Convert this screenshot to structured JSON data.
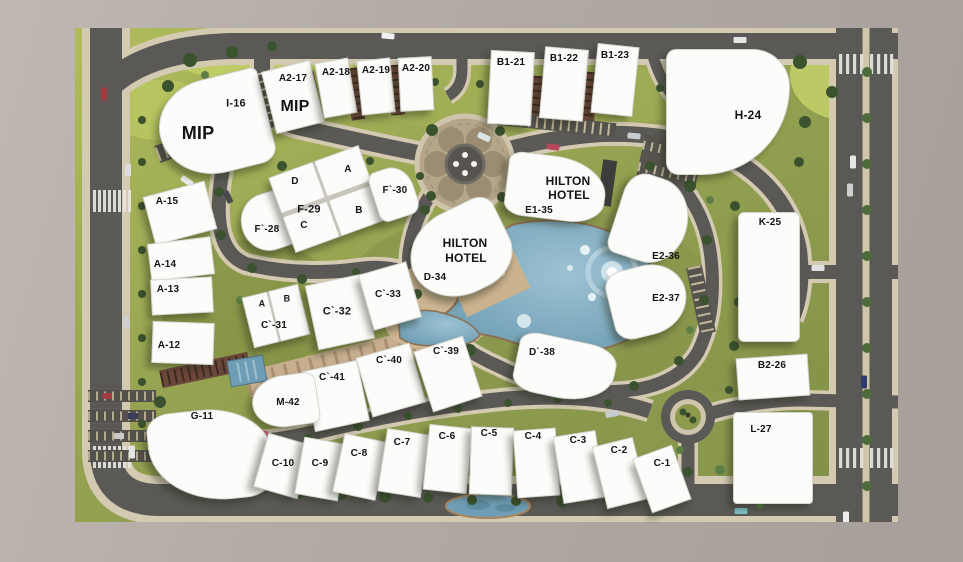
{
  "scene": {
    "name": "residential compound master plan",
    "hotel_name": "HILTON HOTEL",
    "mip_label": "MIP"
  },
  "colors": {
    "frame": "#b2a9a4",
    "grass": "#94a251",
    "road": "#5b5956",
    "sidewalk": "#d4cab2",
    "water": "#6f9db5",
    "beach": "#cdb592",
    "building": "#fcfcfa",
    "label": "#141414"
  },
  "plots": [
    {
      "id": "i-16",
      "x": 214,
      "y": 126,
      "w": 110,
      "h": 96,
      "rot": -14,
      "radius": "55% 8% 18% 60%",
      "texts": [
        {
          "t": "I-16",
          "dx": 22,
          "dy": -22,
          "fs": 11
        },
        {
          "t": "MIP",
          "dx": -16,
          "dy": 7,
          "fs": 18
        }
      ]
    },
    {
      "id": "a2-17",
      "x": 293,
      "y": 97,
      "w": 50,
      "h": 64,
      "rot": -14,
      "texts": [
        {
          "t": "A2-17",
          "dx": 0,
          "dy": -18,
          "fs": 10
        },
        {
          "t": "MIP",
          "dx": 2,
          "dy": 10,
          "fs": 16
        }
      ]
    },
    {
      "id": "a2-18",
      "x": 336,
      "y": 88,
      "w": 34,
      "h": 56,
      "rot": -10,
      "texts": [
        {
          "t": "A2-18",
          "dx": 0,
          "dy": -15,
          "fs": 10
        }
      ]
    },
    {
      "id": "a2-19",
      "x": 376,
      "y": 86,
      "w": 34,
      "h": 55,
      "rot": -6,
      "texts": [
        {
          "t": "A2-19",
          "dx": 0,
          "dy": -15,
          "fs": 10
        }
      ]
    },
    {
      "id": "a2-20",
      "x": 416,
      "y": 84,
      "w": 34,
      "h": 54,
      "rot": -3,
      "texts": [
        {
          "t": "A2-20",
          "dx": 0,
          "dy": -15,
          "fs": 10
        }
      ]
    },
    {
      "id": "b1-21",
      "x": 511,
      "y": 88,
      "w": 44,
      "h": 74,
      "rot": 3,
      "texts": [
        {
          "t": "B1-21",
          "dx": 0,
          "dy": -25,
          "fs": 10
        }
      ]
    },
    {
      "id": "b1-22",
      "x": 564,
      "y": 84,
      "w": 44,
      "h": 72,
      "rot": 5,
      "texts": [
        {
          "t": "B1-22",
          "dx": 0,
          "dy": -25,
          "fs": 10
        }
      ]
    },
    {
      "id": "b1-23",
      "x": 615,
      "y": 80,
      "w": 42,
      "h": 70,
      "rot": 6,
      "texts": [
        {
          "t": "B1-23",
          "dx": 0,
          "dy": -24,
          "fs": 10
        }
      ]
    },
    {
      "id": "h-24",
      "x": 728,
      "y": 112,
      "w": 124,
      "h": 126,
      "rot": 0,
      "radius": "8% 30% 70% 10%",
      "texts": [
        {
          "t": "H-24",
          "dx": 20,
          "dy": 3,
          "fs": 12
        }
      ]
    },
    {
      "id": "a-15",
      "x": 180,
      "y": 213,
      "w": 64,
      "h": 50,
      "rot": -15,
      "texts": [
        {
          "t": "A-15",
          "dx": -13,
          "dy": -11,
          "fs": 10
        }
      ]
    },
    {
      "id": "a-14",
      "x": 181,
      "y": 259,
      "w": 64,
      "h": 38,
      "rot": -7,
      "texts": [
        {
          "t": "A-14",
          "dx": -16,
          "dy": 6,
          "fs": 10
        }
      ]
    },
    {
      "id": "a-13",
      "x": 182,
      "y": 296,
      "w": 62,
      "h": 36,
      "rot": -3,
      "texts": [
        {
          "t": "A-13",
          "dx": -14,
          "dy": -6,
          "fs": 10
        }
      ]
    },
    {
      "id": "a-12",
      "x": 183,
      "y": 343,
      "w": 62,
      "h": 42,
      "rot": 2,
      "texts": [
        {
          "t": "A-12",
          "dx": -14,
          "dy": 3,
          "fs": 10
        }
      ]
    },
    {
      "id": "f-28",
      "x": 268,
      "y": 222,
      "w": 54,
      "h": 58,
      "rot": -18,
      "radius": "60% 15% 20% 60%",
      "texts": [
        {
          "t": "F`-28",
          "dx": -1,
          "dy": 8,
          "fs": 10
        }
      ]
    },
    {
      "id": "f-29",
      "x": 327,
      "y": 199,
      "w": 96,
      "h": 80,
      "rot": -20,
      "divider": "cross",
      "texts": [
        {
          "t": "D",
          "dx": -32,
          "dy": -17,
          "fs": 10
        },
        {
          "t": "A",
          "dx": 21,
          "dy": -29,
          "fs": 10
        },
        {
          "t": "F-29",
          "dx": -18,
          "dy": 11,
          "fs": 11
        },
        {
          "t": "B",
          "dx": 32,
          "dy": 12,
          "fs": 10
        },
        {
          "t": "C",
          "dx": -23,
          "dy": 27,
          "fs": 10
        }
      ]
    },
    {
      "id": "f-30",
      "x": 394,
      "y": 193,
      "w": 42,
      "h": 52,
      "rot": -18,
      "radius": "20% 50% 25% 20%",
      "texts": [
        {
          "t": "F`-30",
          "dx": 1,
          "dy": -2,
          "fs": 10
        }
      ]
    },
    {
      "id": "e1-35",
      "x": 556,
      "y": 188,
      "w": 100,
      "h": 64,
      "rot": 7,
      "radius": "15% 55% 35% 20%",
      "texts": [
        {
          "t": "HILTON",
          "dx": 12,
          "dy": -7,
          "fs": 12
        },
        {
          "t": "HOTEL",
          "dx": 13,
          "dy": 7,
          "fs": 12
        },
        {
          "t": "E1-35",
          "dx": -17,
          "dy": 23,
          "fs": 10
        }
      ]
    },
    {
      "id": "d-34",
      "x": 460,
      "y": 252,
      "w": 102,
      "h": 86,
      "rot": -26,
      "radius": "50% 18% 40% 50%",
      "texts": [
        {
          "t": "HILTON",
          "dx": 5,
          "dy": -9,
          "fs": 12
        },
        {
          "t": "HOTEL",
          "dx": 6,
          "dy": 6,
          "fs": 12
        },
        {
          "t": "D-34",
          "dx": -25,
          "dy": 26,
          "fs": 10
        }
      ]
    },
    {
      "id": "e2-36",
      "x": 652,
      "y": 220,
      "w": 72,
      "h": 86,
      "rot": 18,
      "radius": "30% 55% 50% 15%",
      "texts": [
        {
          "t": "E2-36",
          "dx": 14,
          "dy": 37,
          "fs": 10
        }
      ]
    },
    {
      "id": "e2-37",
      "x": 648,
      "y": 300,
      "w": 78,
      "h": 70,
      "rot": -14,
      "radius": "25% 50% 55% 25%",
      "texts": [
        {
          "t": "E2-37",
          "dx": 18,
          "dy": -1,
          "fs": 10
        }
      ]
    },
    {
      "id": "k-25",
      "x": 769,
      "y": 277,
      "w": 62,
      "h": 130,
      "rot": 0,
      "radius": "6px",
      "texts": [
        {
          "t": "K-25",
          "dx": 1,
          "dy": -54,
          "fs": 10
        }
      ]
    },
    {
      "id": "b2-26",
      "x": 773,
      "y": 377,
      "w": 72,
      "h": 42,
      "rot": -4,
      "texts": [
        {
          "t": "B2-26",
          "dx": -1,
          "dy": -11,
          "fs": 10
        }
      ]
    },
    {
      "id": "l-27",
      "x": 773,
      "y": 458,
      "w": 80,
      "h": 92,
      "rot": 0,
      "radius": "4px",
      "texts": [
        {
          "t": "L-27",
          "dx": -12,
          "dy": -28,
          "fs": 10
        }
      ]
    },
    {
      "id": "c-31",
      "x": 276,
      "y": 316,
      "w": 58,
      "h": 52,
      "rot": -14,
      "divider": "vert",
      "texts": [
        {
          "t": "A",
          "dx": -14,
          "dy": -12,
          "fs": 9
        },
        {
          "t": "B",
          "dx": 11,
          "dy": -17,
          "fs": 9
        },
        {
          "t": "C`-31",
          "dx": -2,
          "dy": 10,
          "fs": 10
        }
      ]
    },
    {
      "id": "c-32",
      "x": 340,
      "y": 312,
      "w": 58,
      "h": 66,
      "rot": -12,
      "texts": [
        {
          "t": "C`-32",
          "dx": -3,
          "dy": 0,
          "fs": 11
        }
      ]
    },
    {
      "id": "c-33",
      "x": 390,
      "y": 296,
      "w": 50,
      "h": 58,
      "rot": -16,
      "texts": [
        {
          "t": "C`-33",
          "dx": -2,
          "dy": -1,
          "fs": 10
        }
      ]
    },
    {
      "id": "c-40",
      "x": 391,
      "y": 380,
      "w": 56,
      "h": 62,
      "rot": -16,
      "texts": [
        {
          "t": "C`-40",
          "dx": -2,
          "dy": -19,
          "fs": 10
        }
      ]
    },
    {
      "id": "c-39",
      "x": 448,
      "y": 374,
      "w": 52,
      "h": 64,
      "rot": -18,
      "texts": [
        {
          "t": "C`-39",
          "dx": -2,
          "dy": -22,
          "fs": 10
        }
      ]
    },
    {
      "id": "c-41",
      "x": 336,
      "y": 396,
      "w": 56,
      "h": 62,
      "rot": -12,
      "texts": [
        {
          "t": "C`-41",
          "dx": -4,
          "dy": -18,
          "fs": 10
        }
      ]
    },
    {
      "id": "m-42",
      "x": 285,
      "y": 401,
      "w": 66,
      "h": 52,
      "rot": -8,
      "radius": "55% 20% 15% 55%",
      "texts": [
        {
          "t": "M-42",
          "dx": 3,
          "dy": 2,
          "fs": 10
        }
      ]
    },
    {
      "id": "d-38",
      "x": 565,
      "y": 369,
      "w": 100,
      "h": 60,
      "rot": 12,
      "radius": "20% 30% 55% 25%",
      "texts": [
        {
          "t": "D`-38",
          "dx": -23,
          "dy": -16,
          "fs": 10
        }
      ]
    },
    {
      "id": "g-11",
      "x": 211,
      "y": 455,
      "w": 124,
      "h": 92,
      "rot": -6,
      "radius": "20% 55% 25% 65%",
      "texts": [
        {
          "t": "G-11",
          "dx": -9,
          "dy": -38,
          "fs": 10
        }
      ]
    },
    {
      "id": "c-10",
      "x": 283,
      "y": 466,
      "w": 46,
      "h": 56,
      "rot": 16,
      "texts": [
        {
          "t": "C-10",
          "dx": 0,
          "dy": -2,
          "fs": 10
        }
      ]
    },
    {
      "id": "c-9",
      "x": 321,
      "y": 469,
      "w": 44,
      "h": 58,
      "rot": 10,
      "texts": [
        {
          "t": "C-9",
          "dx": -1,
          "dy": -5,
          "fs": 10
        }
      ]
    },
    {
      "id": "c-8",
      "x": 360,
      "y": 467,
      "w": 44,
      "h": 60,
      "rot": 12,
      "texts": [
        {
          "t": "C-8",
          "dx": -1,
          "dy": -13,
          "fs": 10
        }
      ]
    },
    {
      "id": "c-7",
      "x": 404,
      "y": 463,
      "w": 44,
      "h": 64,
      "rot": 9,
      "texts": [
        {
          "t": "C-7",
          "dx": -2,
          "dy": -20,
          "fs": 10
        }
      ]
    },
    {
      "id": "c-6",
      "x": 448,
      "y": 459,
      "w": 44,
      "h": 66,
      "rot": 6,
      "texts": [
        {
          "t": "C-6",
          "dx": -1,
          "dy": -22,
          "fs": 10
        }
      ]
    },
    {
      "id": "c-5",
      "x": 491,
      "y": 461,
      "w": 43,
      "h": 68,
      "rot": 2,
      "texts": [
        {
          "t": "C-5",
          "dx": -2,
          "dy": -27,
          "fs": 10
        }
      ]
    },
    {
      "id": "c-4",
      "x": 536,
      "y": 463,
      "w": 43,
      "h": 68,
      "rot": -4,
      "texts": [
        {
          "t": "C-4",
          "dx": -3,
          "dy": -26,
          "fs": 10
        }
      ]
    },
    {
      "id": "c-3",
      "x": 579,
      "y": 467,
      "w": 43,
      "h": 68,
      "rot": -9,
      "texts": [
        {
          "t": "C-3",
          "dx": -1,
          "dy": -26,
          "fs": 10
        }
      ]
    },
    {
      "id": "c-2",
      "x": 620,
      "y": 473,
      "w": 42,
      "h": 64,
      "rot": -14,
      "texts": [
        {
          "t": "C-2",
          "dx": -1,
          "dy": -22,
          "fs": 10
        }
      ]
    },
    {
      "id": "c-1",
      "x": 662,
      "y": 479,
      "w": 42,
      "h": 58,
      "rot": -20,
      "texts": [
        {
          "t": "C-1",
          "dx": 0,
          "dy": -15,
          "fs": 10
        }
      ]
    }
  ]
}
